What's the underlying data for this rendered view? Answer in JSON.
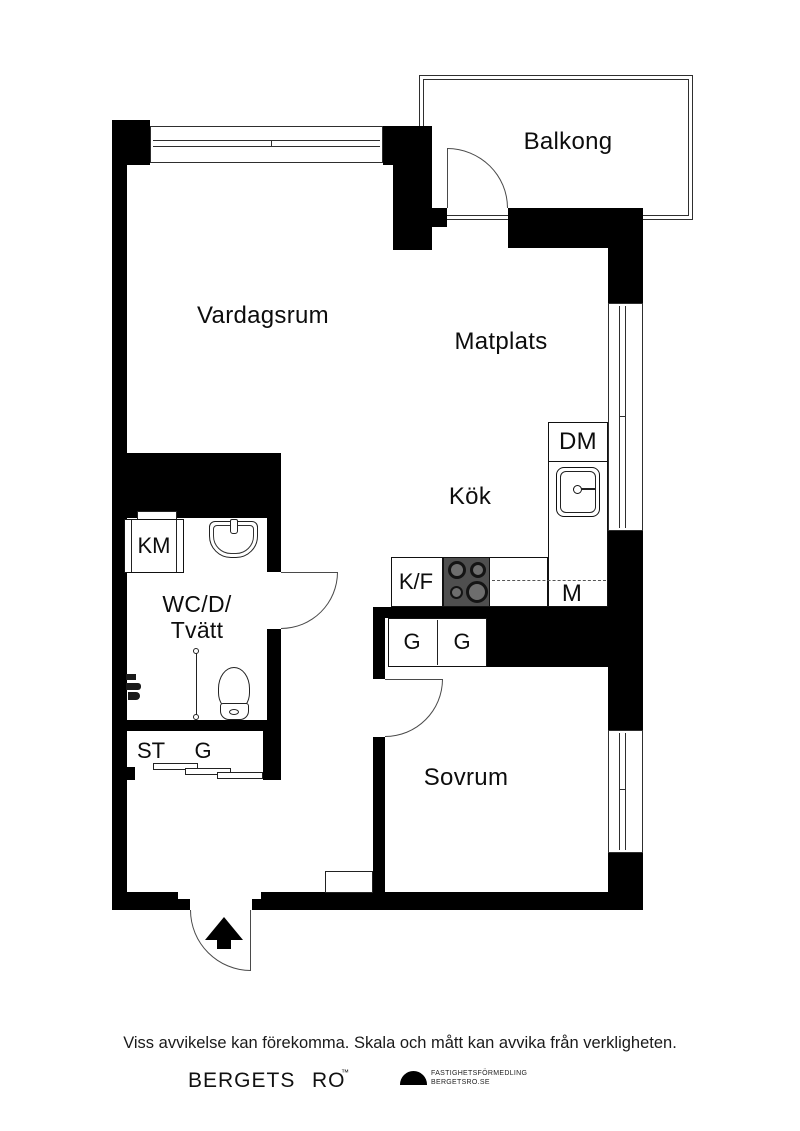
{
  "plan": {
    "rooms": {
      "balcony": "Balkong",
      "living_room": "Vardagsrum",
      "dining": "Matplats",
      "kitchen": "Kök",
      "bathroom_line1": "WC/D/",
      "bathroom_line2": "Tvätt",
      "bedroom": "Sovrum"
    },
    "fixtures": {
      "dishwasher": "DM",
      "microwave": "M",
      "fridge_freezer": "K/F",
      "washing_machine": "KM",
      "hall_closet_st": "ST",
      "hall_closet_g": "G",
      "bedroom_wardrobe_1": "G",
      "bedroom_wardrobe_2": "G"
    }
  },
  "footer": {
    "disclaimer": "Viss avvikelse kan förekomma. Skala och mått kan avvika från verkligheten.",
    "brand": {
      "word1": "BERGETS",
      "word2": "RO",
      "trademark": "™",
      "tagline_line1": "FASTIGHETSFÖRMEDLING",
      "tagline_line2": "BERGETSRO.SE"
    }
  },
  "colors": {
    "wall": "#000000",
    "line": "#3a3a3a",
    "stove": "#4f4f4f"
  }
}
